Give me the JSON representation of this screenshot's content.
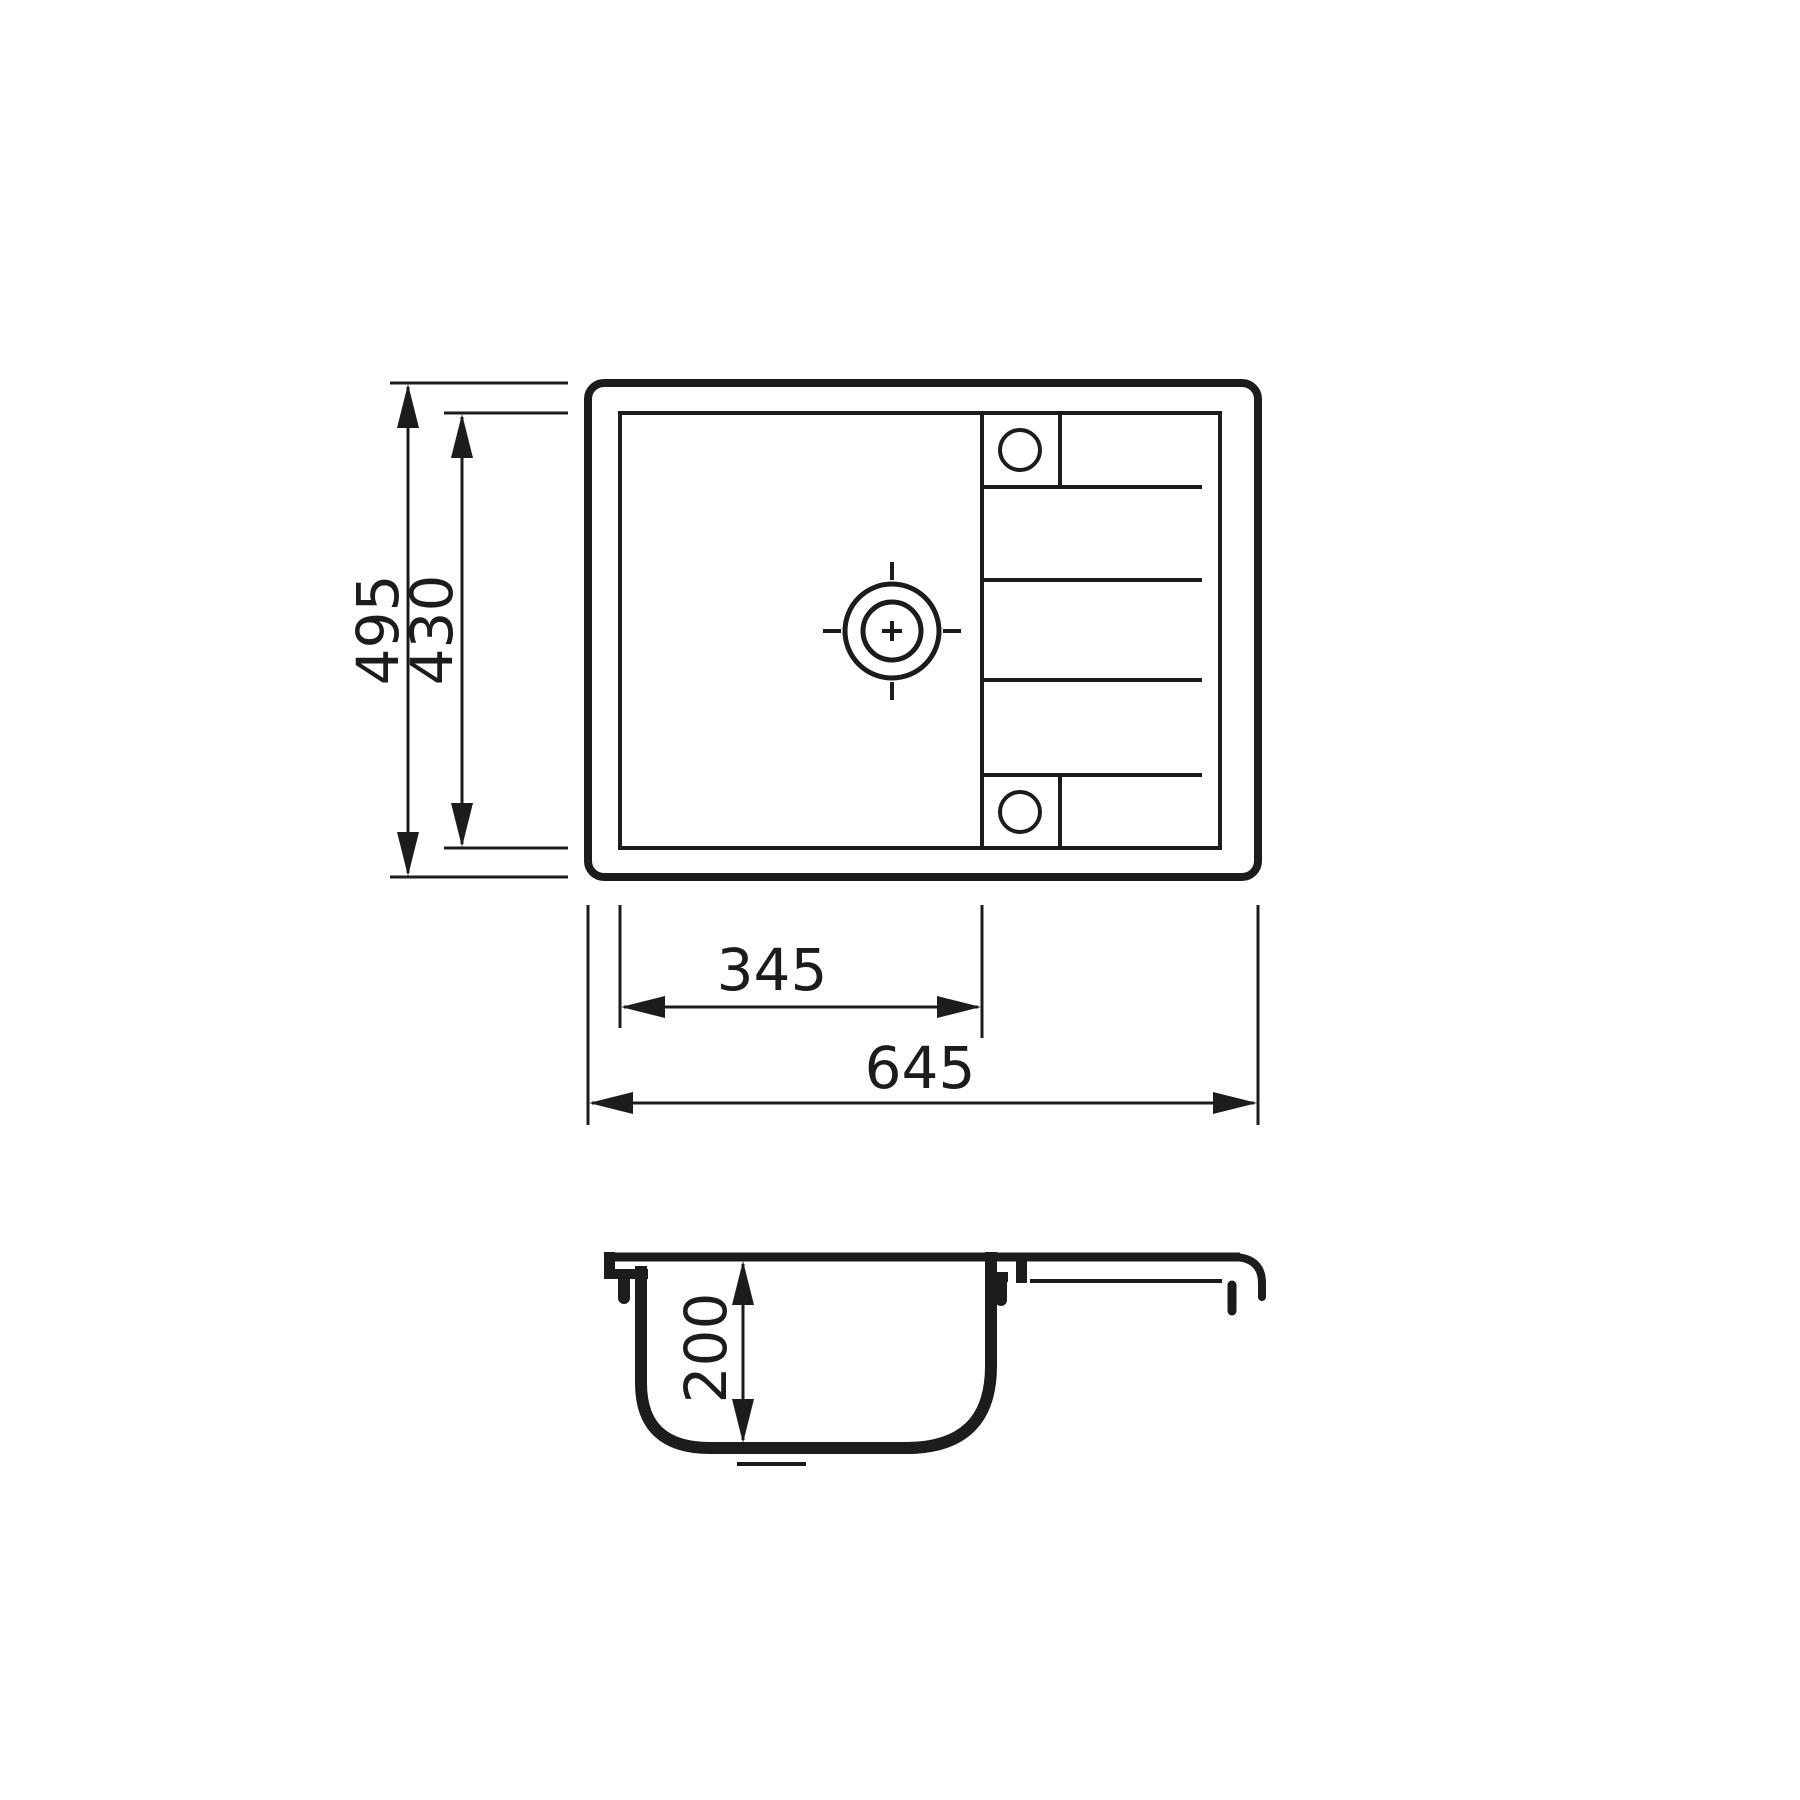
{
  "drawing": {
    "type": "technical-dimension-drawing",
    "subject": "sink-top-and-section-view",
    "colors": {
      "ink": "#1c1c1c",
      "background": "#ffffff"
    }
  },
  "dimensions": {
    "overall_height": {
      "value": "495"
    },
    "inner_height": {
      "value": "430"
    },
    "bowl_width": {
      "value": "345"
    },
    "overall_width": {
      "value": "645"
    },
    "bowl_depth": {
      "value": "200"
    }
  }
}
